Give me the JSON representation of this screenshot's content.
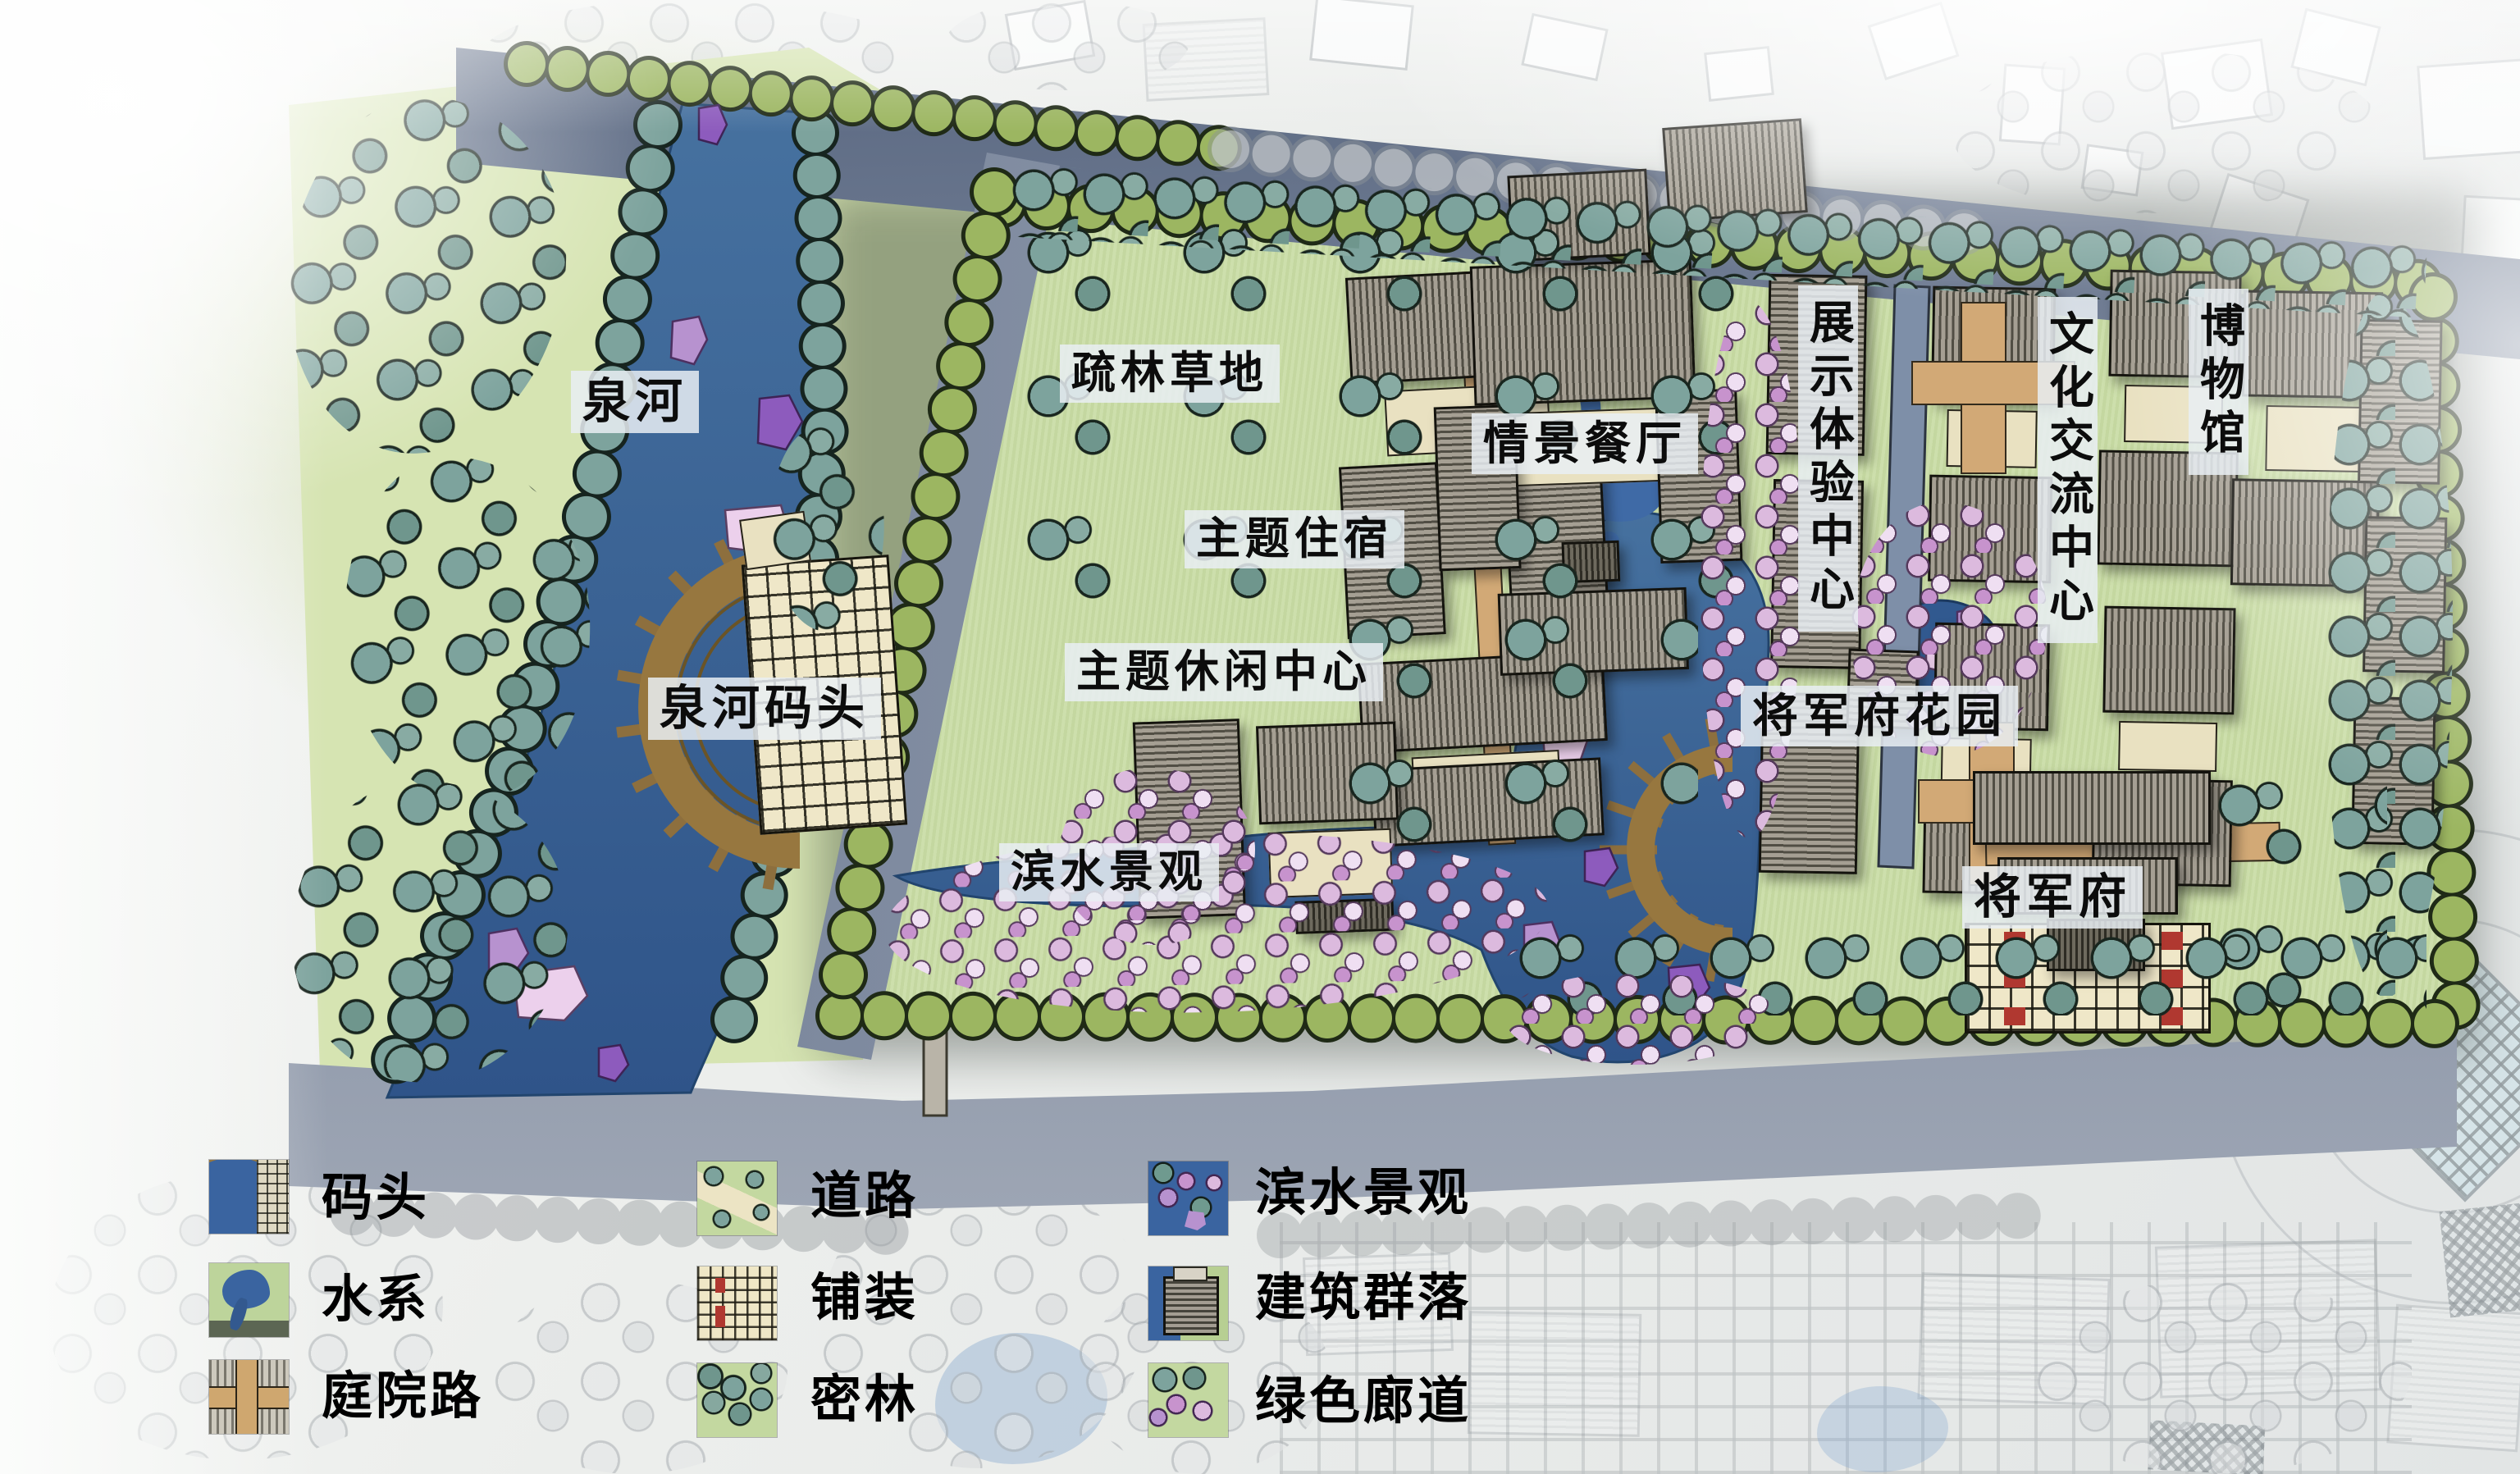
{
  "map_labels": {
    "river": "泉河",
    "river_dock": "泉河码头",
    "sparse_woodland_lawn": "疏林草地",
    "theme_lodging": "主题住宿",
    "scene_restaurant": "情景餐厅",
    "theme_leisure_center": "主题休闲中心",
    "waterfront_scenery": "滨水景观",
    "exhibition_center": "展示体验中心",
    "cultural_exchange_center": "文化交流中心",
    "museum": "博物馆",
    "generals_mansion_garden": "将军府花园",
    "generals_mansion": "将军府"
  },
  "legend": {
    "items": [
      {
        "id": "dock",
        "label": "码头"
      },
      {
        "id": "water-system",
        "label": "水系"
      },
      {
        "id": "courtyard-road",
        "label": "庭院路"
      },
      {
        "id": "road",
        "label": "道路"
      },
      {
        "id": "paving",
        "label": "铺装"
      },
      {
        "id": "dense-forest",
        "label": "密林"
      },
      {
        "id": "waterfront",
        "label": "滨水景观"
      },
      {
        "id": "building-cluster",
        "label": "建筑群落"
      },
      {
        "id": "green-corridor",
        "label": "绿色廊道"
      }
    ]
  },
  "colors": {
    "water": "#3a64a0",
    "lawn": "#c9dca5",
    "meadow": "#d6e4b2",
    "road": "#8893a6",
    "tree_teal": "#7da39d",
    "tree_green": "#9cb661",
    "shrub_pink": "#dcbade",
    "dock_brown": "#97773f",
    "label_bg": "#e9eef3",
    "paving": "#efe7c6",
    "accent_red": "#b03830"
  }
}
